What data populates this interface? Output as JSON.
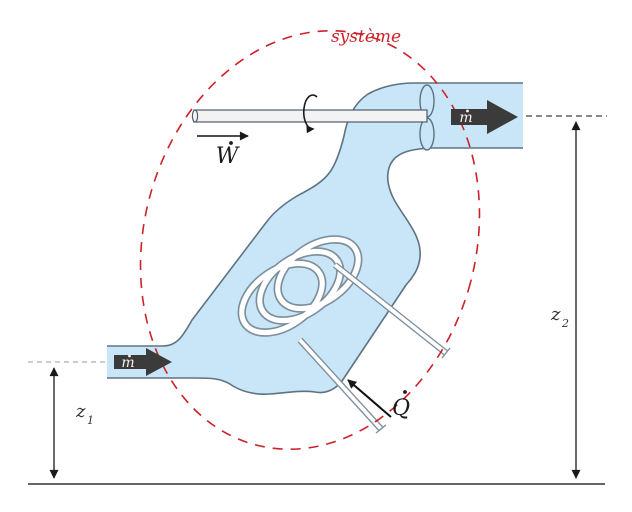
{
  "diagram": {
    "system_label": "système",
    "work_label": "W",
    "heat_label": "Q",
    "mass_flow_in_label": "m",
    "mass_flow_out_label": "m",
    "height_in": {
      "letter": "z",
      "subscript": "1"
    },
    "height_out": {
      "letter": "z",
      "subscript": "2"
    },
    "icons": {
      "mass_flow_arrow": "thick-right-arrow",
      "rotation_arrow": "curved-rotation-arc",
      "work_arrow": "right-arrow",
      "heat_arrow": "up-left-arrow",
      "height_marker": "double-headed-vertical-arrow",
      "system_boundary": "red-dashed-ellipse"
    },
    "colors": {
      "fluid": "#c9e6f8",
      "outline": "#5d7382",
      "boundary": "#cc2129",
      "arrow": "#3b3b3b",
      "shaft": "#f3f3f3",
      "ground": "#666666",
      "ref_dash": "#999999"
    }
  }
}
